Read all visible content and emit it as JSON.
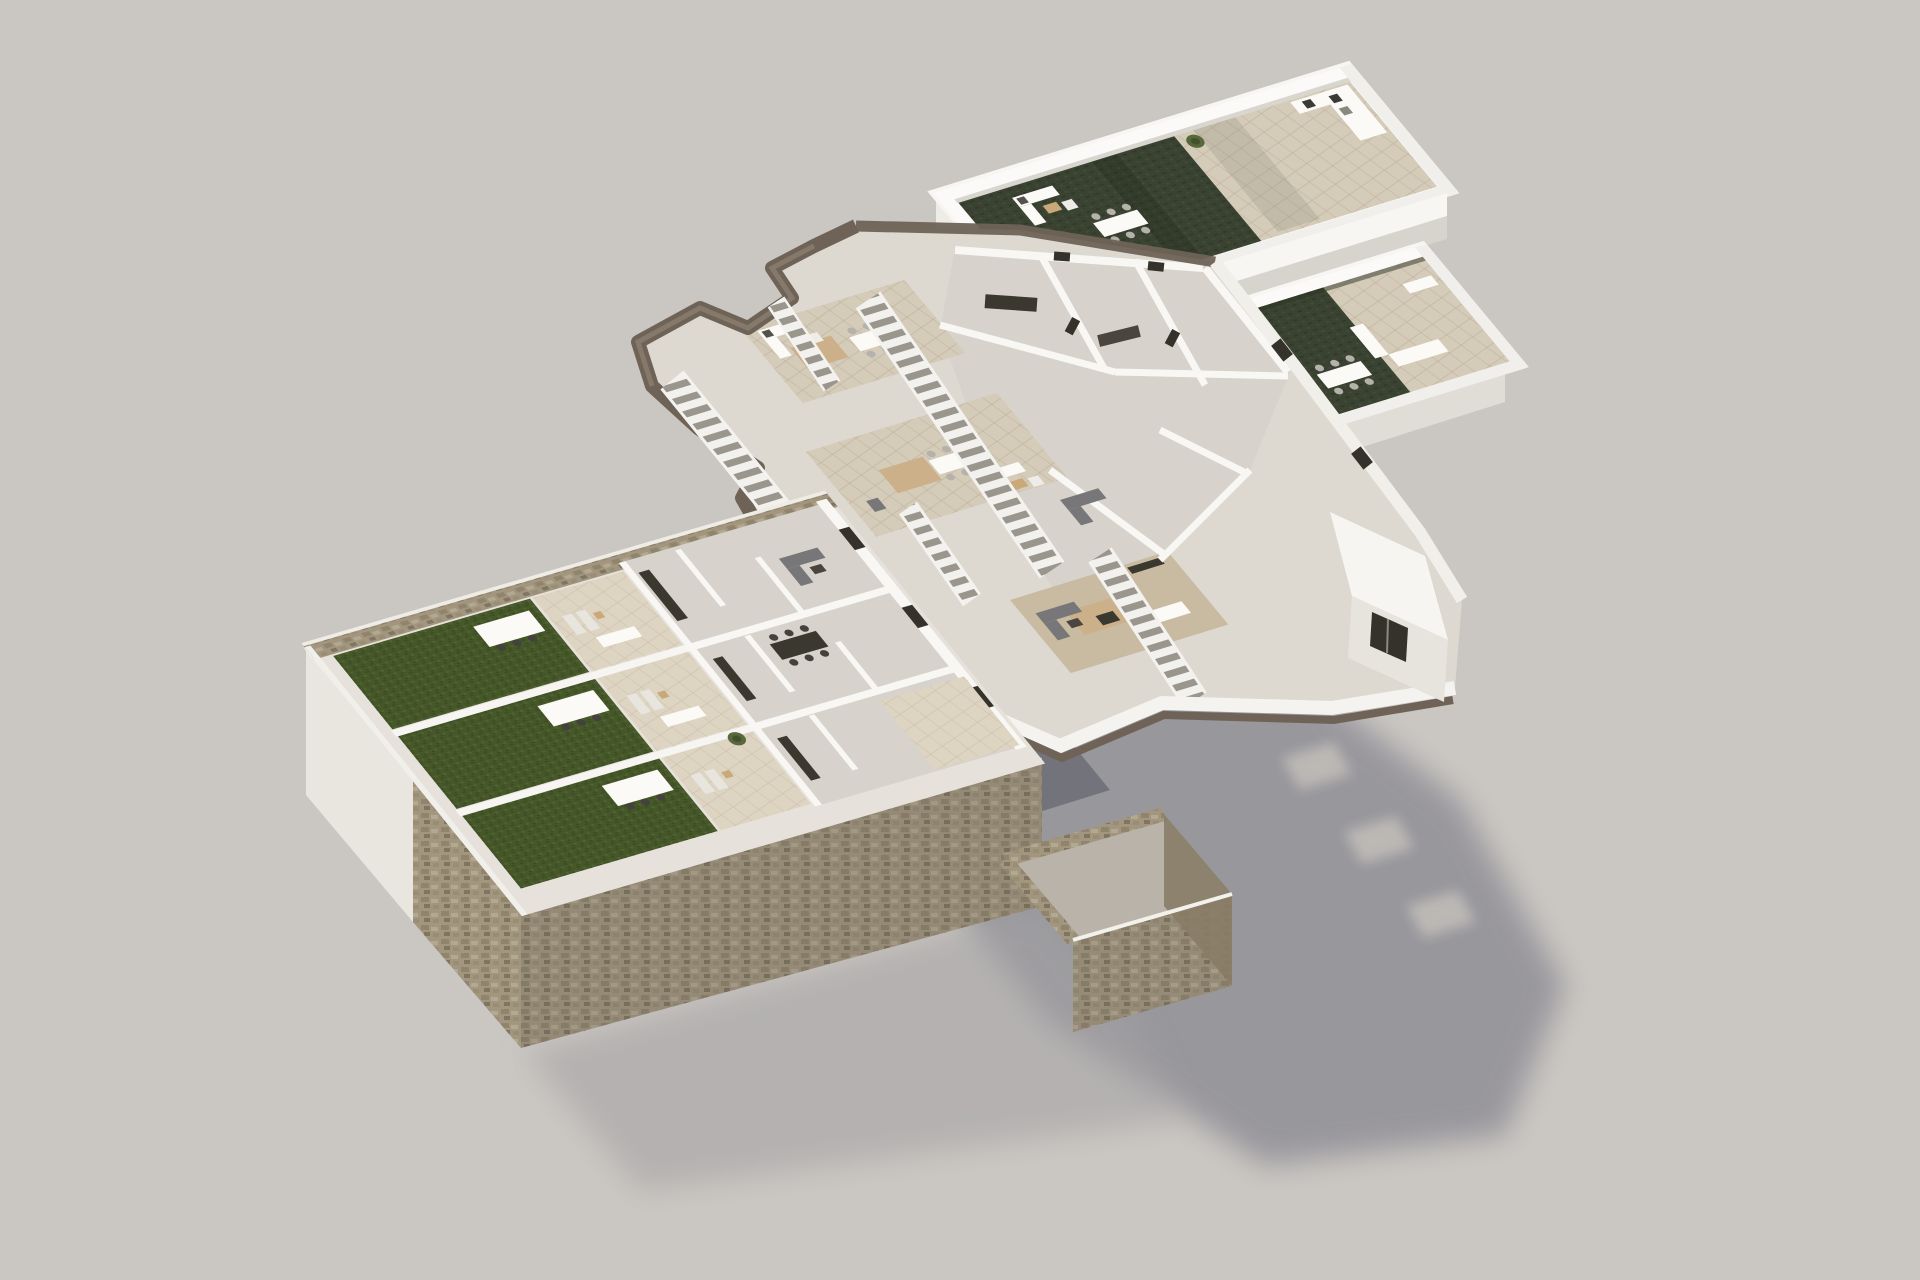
{
  "scene": {
    "type": "3d-exploded-axonometric-floorplan-render",
    "description": "Photoreal 3D render of a three-level apartment building exploded vertically over a neutral ground plane",
    "levels": [
      {
        "id": "roof-terrace-level",
        "name": "roof-terraces",
        "position": "top-right",
        "features": [
          "white-parapet-walls",
          "artificial-turf-decks",
          "beige-tile-decks",
          "outdoor-sofa-sets",
          "outdoor-dining-tables",
          "parasol",
          "potted-plants",
          "long-spine-wall"
        ]
      },
      {
        "id": "upper-floor",
        "name": "upper-floor-plate",
        "position": "center",
        "features": [
          "jagged-rock-cliff-edge",
          "long-white-staircases",
          "open-terraces-with-dining-sets",
          "lounge-sofas",
          "interior-rooms-with-white-walls",
          "dark-kitchen-counters",
          "wood-floor-living-room",
          "white-fascia-with-brown-underside",
          "end-wall-with-dark-window"
        ]
      },
      {
        "id": "ground-floor",
        "name": "ground-floor-podium",
        "position": "bottom-left",
        "features": [
          "rubble-stone-perimeter-walls",
          "three-private-lawns",
          "pergola-dining-sets",
          "patio-terraces",
          "interior-rooms",
          "stone-podium-faces",
          "driveway-ramp",
          "stone-walled-yard"
        ]
      }
    ],
    "lighting": {
      "sun_direction": "upper-left",
      "cast_shadow": {
        "cast_by": "upper-floor-plate",
        "direction": "lower-right",
        "skylight_holes": 3
      }
    }
  },
  "palette": {
    "background": "#cac6c2",
    "background_edge": "#c3bfbb",
    "shadow": "#8e8d94",
    "shadow_soft": "#a3a1a3",
    "lawn_green": "#46582a",
    "roof_turf": "#3a4231",
    "tile_beige": "#d5cbb9",
    "tile_light": "#ded4c2",
    "stone": "#a2967f",
    "stone_dark": "#887c67",
    "cliff_brown": "#6e6356",
    "wall_white": "#f7f6f2",
    "wall_shade": "#d8d4cd",
    "wall_cream": "#e9e6df",
    "room_floor": "#d7d2cb",
    "wood_floor": "#c9bba2",
    "slab_base": "#e6e2db",
    "furniture_dark": "#38362f",
    "furniture_gray": "#77777a",
    "umbrella_tan": "#c3a87e",
    "rug_tan": "#cbb089",
    "plant_green": "#57683a",
    "driveway_gray": "#73737b",
    "stair_gap": "#9a968e"
  }
}
